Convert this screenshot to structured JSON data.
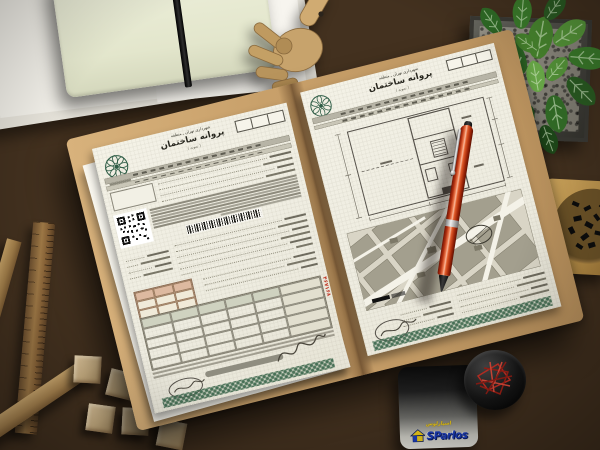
{
  "documents": {
    "left_page": {
      "authority_line": "شهرداری تهران ـ منطقه",
      "title": "پروانه ساختمان",
      "note": "( نمونه )",
      "serial_number": "۴۶۷۱۶۸"
    },
    "right_page": {
      "authority_line": "شهرداری تهران ـ منطقه",
      "title": "پروانه ساختمان",
      "note": "( نمونه )"
    }
  },
  "brand_card": {
    "tagline": "اسپارلوس",
    "name": "SParlos"
  },
  "icons": {
    "municipality_logo": "tehran-municipality-flower-logo",
    "qr_code": "qr-code",
    "barcode": "barcode",
    "signature": "handwritten-signature",
    "security_strip": "green-guilloche-strip",
    "house_logo": "sparlos-house"
  },
  "colors": {
    "desk_wood": "#43311f",
    "folder_tan": "#c8a06a",
    "paper": "#f1efe4",
    "logo_green": "#2f5d46",
    "strip_green": "#3f6a50",
    "serial_red": "#c23b2a",
    "pen_red": "#d8502a",
    "brand_blue": "#1d3fbf",
    "brand_yellow": "#f3cf1a",
    "plant_green": "#3b7d2b"
  }
}
